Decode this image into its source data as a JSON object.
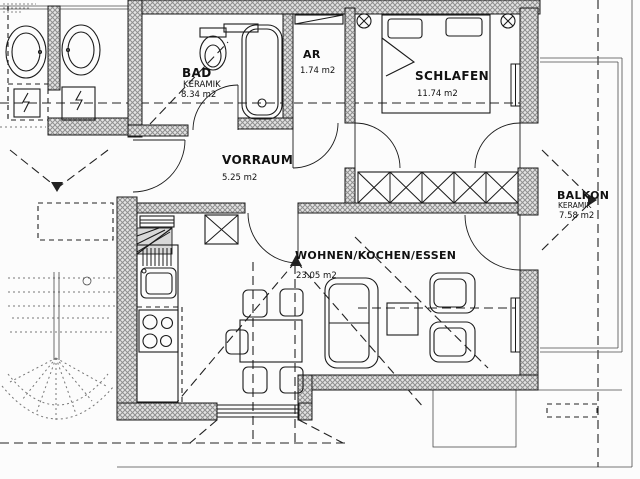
{
  "rooms": {
    "bad": {
      "name": "BAD",
      "finish": "KERAMIK",
      "area": "8.34 m2"
    },
    "ar": {
      "name": "AR",
      "area": "1.74 m2"
    },
    "schlafen": {
      "name": "SCHLAFEN",
      "area": "11.74 m2"
    },
    "vorraum": {
      "name": "VORRAUM",
      "area": "5.25 m2"
    },
    "wohnen": {
      "name": "WOHNEN/KOCHEN/ESSEN",
      "area": "23.05 m2"
    },
    "balkon": {
      "name": "BALKON",
      "finish": "KERAMIK",
      "area": "7.58 m2"
    }
  },
  "colors": {
    "paper": "#fcfcfc",
    "ink": "#1a1a1a",
    "wall_hatch": "#8f8f8f",
    "wall_base": "#e4e4e4",
    "faint_lines": "#777777"
  }
}
